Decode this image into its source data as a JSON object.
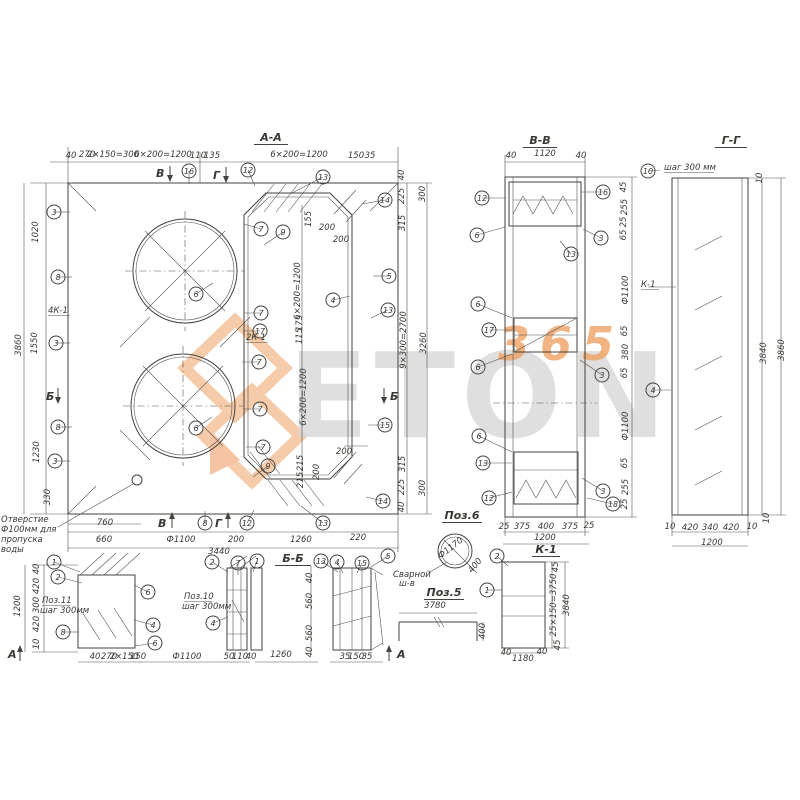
{
  "doc": {
    "type": "reinforcement-drawing",
    "note_lines": [
      "Отверстие",
      "Ф100мм для",
      "пропуска",
      "воды"
    ],
    "ink_color": "#44423e",
    "accent_color": "#ef9459"
  },
  "watermark": {
    "brand": "ETON",
    "digits": "365"
  },
  "titles": [
    {
      "t": "А-А",
      "x": 271,
      "y": 141,
      "w": 34
    },
    {
      "t": "В-В",
      "x": 540,
      "y": 144,
      "w": 34
    },
    {
      "t": "Г-Г",
      "x": 731,
      "y": 144,
      "w": 32
    },
    {
      "t": "Б-Б",
      "x": 293,
      "y": 562,
      "w": 36
    },
    {
      "t": "Поз.6",
      "x": 462,
      "y": 519,
      "w": 40
    },
    {
      "t": "Поз.5",
      "x": 444,
      "y": 596,
      "w": 40
    },
    {
      "t": "К-1",
      "x": 546,
      "y": 553,
      "w": 28
    }
  ],
  "labels": [
    {
      "t": "4К-1",
      "x": 48,
      "y": 313,
      "u": 22
    },
    {
      "t": "2К-1",
      "x": 246,
      "y": 340,
      "u": 22
    },
    {
      "t": "К-1",
      "x": 641,
      "y": 287,
      "u": 18
    },
    {
      "t": "шаг 300 мм",
      "x": 664,
      "y": 170,
      "u": 50
    },
    {
      "t": "Поз.11",
      "x": 42,
      "y": 603,
      "u": 28
    },
    {
      "t": "шаг 300мм",
      "x": 40,
      "y": 613
    },
    {
      "t": "Поз.10",
      "x": 184,
      "y": 599,
      "u": 28
    },
    {
      "t": "шаг 300мм",
      "x": 182,
      "y": 609
    },
    {
      "t": "Сварной",
      "x": 393,
      "y": 577
    },
    {
      "t": "ш-в",
      "x": 399,
      "y": 586
    },
    {
      "t": "Отверстие",
      "x": 1,
      "y": 522
    },
    {
      "t": "Ф100мм для",
      "x": 1,
      "y": 532
    },
    {
      "t": "пропуска",
      "x": 1,
      "y": 542
    },
    {
      "t": "воды",
      "x": 1,
      "y": 552
    }
  ],
  "dims": [
    {
      "t": "40",
      "x": 71,
      "y": 158,
      "fs": 7
    },
    {
      "t": "270",
      "x": 87,
      "y": 157
    },
    {
      "t": "2×150=300",
      "x": 113,
      "y": 157,
      "fs": 6.5
    },
    {
      "t": "6×200=1200",
      "x": 163,
      "y": 157
    },
    {
      "t": "110",
      "x": 198,
      "y": 158,
      "fs": 7
    },
    {
      "t": "135",
      "x": 212,
      "y": 158,
      "fs": 7
    },
    {
      "t": "6×200=1200",
      "x": 299,
      "y": 157
    },
    {
      "t": "150",
      "x": 356,
      "y": 158,
      "fs": 7
    },
    {
      "t": "35",
      "x": 370,
      "y": 158,
      "fs": 7
    },
    {
      "t": "1020",
      "x": 38,
      "y": 232,
      "r": -90
    },
    {
      "t": "1550",
      "x": 37,
      "y": 343,
      "r": -90
    },
    {
      "t": "1230",
      "x": 39,
      "y": 452,
      "r": -90
    },
    {
      "t": "330",
      "x": 50,
      "y": 497,
      "r": -90
    },
    {
      "t": "3860",
      "x": 21,
      "y": 345,
      "r": -90
    },
    {
      "t": "40",
      "x": 404,
      "y": 175,
      "r": -90,
      "fs": 7
    },
    {
      "t": "225",
      "x": 404,
      "y": 196,
      "r": -90
    },
    {
      "t": "315",
      "x": 405,
      "y": 223,
      "r": -90
    },
    {
      "t": "9×300=2700",
      "x": 406,
      "y": 340,
      "r": -90
    },
    {
      "t": "315",
      "x": 405,
      "y": 464,
      "r": -90
    },
    {
      "t": "225",
      "x": 404,
      "y": 487,
      "r": -90
    },
    {
      "t": "40",
      "x": 404,
      "y": 507,
      "r": -90,
      "fs": 7
    },
    {
      "t": "300",
      "x": 425,
      "y": 194,
      "r": -90
    },
    {
      "t": "3260",
      "x": 426,
      "y": 343,
      "r": -90
    },
    {
      "t": "300",
      "x": 425,
      "y": 488,
      "r": -90
    },
    {
      "t": "760",
      "x": 105,
      "y": 525
    },
    {
      "t": "660",
      "x": 104,
      "y": 542
    },
    {
      "t": "Ф1100",
      "x": 181,
      "y": 542
    },
    {
      "t": "200",
      "x": 236,
      "y": 542
    },
    {
      "t": "1260",
      "x": 301,
      "y": 542
    },
    {
      "t": "220",
      "x": 358,
      "y": 540
    },
    {
      "t": "3440",
      "x": 219,
      "y": 554
    },
    {
      "t": "155",
      "x": 311,
      "y": 219,
      "r": -90,
      "fs": 7
    },
    {
      "t": "200",
      "x": 327,
      "y": 230,
      "fs": 7
    },
    {
      "t": "200",
      "x": 341,
      "y": 242,
      "fs": 7
    },
    {
      "t": "6×200=1200",
      "x": 300,
      "y": 291,
      "r": -90
    },
    {
      "t": "175",
      "x": 302,
      "y": 323,
      "r": -90,
      "fs": 7
    },
    {
      "t": "115",
      "x": 302,
      "y": 336,
      "r": -90,
      "fs": 7
    },
    {
      "t": "6×200=1200",
      "x": 306,
      "y": 397,
      "r": -90
    },
    {
      "t": "215",
      "x": 303,
      "y": 463,
      "r": -90,
      "fs": 7
    },
    {
      "t": "215",
      "x": 303,
      "y": 480,
      "r": -90,
      "fs": 7
    },
    {
      "t": "200",
      "x": 344,
      "y": 454,
      "fs": 7
    },
    {
      "t": "200",
      "x": 319,
      "y": 472,
      "r": -90,
      "fs": 7
    },
    {
      "t": "40",
      "x": 511,
      "y": 158,
      "fs": 7
    },
    {
      "t": "1120",
      "x": 545,
      "y": 156
    },
    {
      "t": "40",
      "x": 581,
      "y": 158,
      "fs": 7
    },
    {
      "t": "45",
      "x": 626,
      "y": 187,
      "r": -90,
      "fs": 7
    },
    {
      "t": "255",
      "x": 627,
      "y": 207,
      "r": -90
    },
    {
      "t": "25",
      "x": 626,
      "y": 222,
      "r": -90,
      "fs": 7
    },
    {
      "t": "65",
      "x": 626,
      "y": 235,
      "r": -90,
      "fs": 7
    },
    {
      "t": "Ф1100",
      "x": 628,
      "y": 290,
      "r": -90
    },
    {
      "t": "65",
      "x": 627,
      "y": 331,
      "r": -90,
      "fs": 7
    },
    {
      "t": "380",
      "x": 628,
      "y": 352,
      "r": -90
    },
    {
      "t": "65",
      "x": 627,
      "y": 373,
      "r": -90,
      "fs": 7
    },
    {
      "t": "Ф1100",
      "x": 628,
      "y": 426,
      "r": -90
    },
    {
      "t": "65",
      "x": 627,
      "y": 463,
      "r": -90,
      "fs": 7
    },
    {
      "t": "255",
      "x": 628,
      "y": 487,
      "r": -90
    },
    {
      "t": "25",
      "x": 627,
      "y": 504,
      "r": -90,
      "fs": 7
    },
    {
      "t": "25",
      "x": 504,
      "y": 529,
      "fs": 7
    },
    {
      "t": "375",
      "x": 522,
      "y": 529
    },
    {
      "t": "400",
      "x": 546,
      "y": 529
    },
    {
      "t": "375",
      "x": 570,
      "y": 529
    },
    {
      "t": "25",
      "x": 589,
      "y": 528,
      "fs": 7
    },
    {
      "t": "1200",
      "x": 545,
      "y": 540
    },
    {
      "t": "10",
      "x": 762,
      "y": 178,
      "r": -90,
      "fs": 7
    },
    {
      "t": "3840",
      "x": 766,
      "y": 353,
      "r": -90
    },
    {
      "t": "3860",
      "x": 784,
      "y": 350,
      "r": -90
    },
    {
      "t": "10",
      "x": 769,
      "y": 518,
      "r": -90,
      "fs": 7
    },
    {
      "t": "10",
      "x": 670,
      "y": 529,
      "fs": 7
    },
    {
      "t": "420",
      "x": 690,
      "y": 530
    },
    {
      "t": "340",
      "x": 710,
      "y": 530
    },
    {
      "t": "420",
      "x": 731,
      "y": 530
    },
    {
      "t": "10",
      "x": 752,
      "y": 529,
      "fs": 7
    },
    {
      "t": "1200",
      "x": 712,
      "y": 545
    },
    {
      "t": "40",
      "x": 39,
      "y": 569,
      "r": -90,
      "fs": 7
    },
    {
      "t": "420",
      "x": 39,
      "y": 586,
      "r": -90
    },
    {
      "t": "300",
      "x": 39,
      "y": 605,
      "r": -90
    },
    {
      "t": "420",
      "x": 39,
      "y": 624,
      "r": -90
    },
    {
      "t": "10",
      "x": 39,
      "y": 644,
      "r": -90,
      "fs": 7
    },
    {
      "t": "1200",
      "x": 20,
      "y": 606,
      "r": -90
    },
    {
      "t": "40",
      "x": 312,
      "y": 578,
      "r": -90,
      "fs": 7
    },
    {
      "t": "560",
      "x": 312,
      "y": 601,
      "r": -90
    },
    {
      "t": "560",
      "x": 312,
      "y": 633,
      "r": -90
    },
    {
      "t": "40",
      "x": 312,
      "y": 652,
      "r": -90,
      "fs": 7
    },
    {
      "t": "40",
      "x": 95,
      "y": 659,
      "fs": 6.5
    },
    {
      "t": "270",
      "x": 109,
      "y": 659,
      "fs": 6.5
    },
    {
      "t": "2×150",
      "x": 124,
      "y": 659,
      "fs": 6.5
    },
    {
      "t": "150",
      "x": 138,
      "y": 659,
      "fs": 6.5
    },
    {
      "t": "Ф1100",
      "x": 187,
      "y": 659
    },
    {
      "t": "50",
      "x": 229,
      "y": 659,
      "fs": 6.5
    },
    {
      "t": "110",
      "x": 240,
      "y": 659,
      "fs": 6.5
    },
    {
      "t": "40",
      "x": 251,
      "y": 659,
      "fs": 6.5
    },
    {
      "t": "1260",
      "x": 281,
      "y": 657
    },
    {
      "t": "35",
      "x": 345,
      "y": 659,
      "fs": 6.5
    },
    {
      "t": "150",
      "x": 356,
      "y": 659,
      "fs": 6.5
    },
    {
      "t": "35",
      "x": 367,
      "y": 659,
      "fs": 6.5
    },
    {
      "t": "3780",
      "x": 435,
      "y": 608
    },
    {
      "t": "400",
      "x": 485,
      "y": 631,
      "r": -90
    },
    {
      "t": "Ф1170",
      "x": 452,
      "y": 550,
      "r": -38
    },
    {
      "t": "400",
      "x": 477,
      "y": 567,
      "r": -50,
      "fs": 7
    },
    {
      "t": "45",
      "x": 558,
      "y": 567,
      "r": -90,
      "fs": 7
    },
    {
      "t": "25×150=3750",
      "x": 556,
      "y": 605,
      "r": -90,
      "fs": 6.5
    },
    {
      "t": "3840",
      "x": 569,
      "y": 605,
      "r": -90
    },
    {
      "t": "45",
      "x": 560,
      "y": 645,
      "r": -90,
      "fs": 7
    },
    {
      "t": "40",
      "x": 506,
      "y": 655,
      "fs": 6.5
    },
    {
      "t": "1180",
      "x": 523,
      "y": 661
    },
    {
      "t": "40",
      "x": 542,
      "y": 654,
      "fs": 6.5
    }
  ],
  "bubbles": [
    {
      "n": "16",
      "x": 189,
      "y": 171,
      "lx": 189,
      "ly": 184
    },
    {
      "n": "12",
      "x": 248,
      "y": 170,
      "lx": 255,
      "ly": 186
    },
    {
      "n": "13",
      "x": 323,
      "y": 177,
      "lx": 292,
      "ly": 193
    },
    {
      "n": "14",
      "x": 385,
      "y": 200,
      "lx": 362,
      "ly": 204
    },
    {
      "n": "3",
      "x": 54,
      "y": 212,
      "lx": 70,
      "ly": 212
    },
    {
      "n": "8",
      "x": 58,
      "y": 277,
      "lx": 72,
      "ly": 277
    },
    {
      "n": "3",
      "x": 56,
      "y": 343,
      "lx": 70,
      "ly": 343
    },
    {
      "n": "8",
      "x": 58,
      "y": 427,
      "lx": 72,
      "ly": 427
    },
    {
      "n": "3",
      "x": 55,
      "y": 461,
      "lx": 70,
      "ly": 461
    },
    {
      "n": "7",
      "x": 261,
      "y": 229,
      "lx": 244,
      "ly": 224
    },
    {
      "n": "9",
      "x": 283,
      "y": 232,
      "lx": 264,
      "ly": 245
    },
    {
      "n": "6",
      "x": 196,
      "y": 294,
      "lx": 213,
      "ly": 283
    },
    {
      "n": "7",
      "x": 261,
      "y": 313,
      "lx": 244,
      "ly": 313
    },
    {
      "n": "17",
      "x": 260,
      "y": 331,
      "lx": 243,
      "ly": 331
    },
    {
      "n": "5",
      "x": 389,
      "y": 276,
      "lx": 373,
      "ly": 276
    },
    {
      "n": "4",
      "x": 333,
      "y": 300,
      "lx": 350,
      "ly": 296
    },
    {
      "n": "13",
      "x": 388,
      "y": 310,
      "lx": 371,
      "ly": 318
    },
    {
      "n": "7",
      "x": 259,
      "y": 362,
      "lx": 242,
      "ly": 362
    },
    {
      "n": "7",
      "x": 260,
      "y": 409,
      "lx": 243,
      "ly": 409
    },
    {
      "n": "6",
      "x": 196,
      "y": 428,
      "lx": 212,
      "ly": 417
    },
    {
      "n": "7",
      "x": 263,
      "y": 447,
      "lx": 246,
      "ly": 447
    },
    {
      "n": "9",
      "x": 268,
      "y": 466,
      "lx": 253,
      "ly": 477
    },
    {
      "n": "15",
      "x": 385,
      "y": 425,
      "lx": 368,
      "ly": 425
    },
    {
      "n": "14",
      "x": 383,
      "y": 501,
      "lx": 366,
      "ly": 497
    },
    {
      "n": "8",
      "x": 205,
      "y": 523,
      "lx": 205,
      "ly": 511
    },
    {
      "n": "12",
      "x": 247,
      "y": 523,
      "lx": 254,
      "ly": 510
    },
    {
      "n": "13",
      "x": 323,
      "y": 523,
      "lx": 301,
      "ly": 506
    },
    {
      "n": "12",
      "x": 482,
      "y": 198,
      "lx": 506,
      "ly": 198
    },
    {
      "n": "16",
      "x": 603,
      "y": 192,
      "lx": 581,
      "ly": 192
    },
    {
      "n": "6",
      "x": 477,
      "y": 235,
      "lx": 505,
      "ly": 227
    },
    {
      "n": "3",
      "x": 601,
      "y": 238,
      "lx": 583,
      "ly": 229
    },
    {
      "n": "13",
      "x": 571,
      "y": 254,
      "lx": 560,
      "ly": 241
    },
    {
      "n": "6",
      "x": 478,
      "y": 304,
      "lx": 512,
      "ly": 318
    },
    {
      "n": "17",
      "x": 489,
      "y": 330,
      "lx": 512,
      "ly": 330
    },
    {
      "n": "6",
      "x": 478,
      "y": 367,
      "lx": 512,
      "ly": 354
    },
    {
      "n": "3",
      "x": 602,
      "y": 375,
      "lx": 580,
      "ly": 360
    },
    {
      "n": "6",
      "x": 479,
      "y": 436,
      "lx": 512,
      "ly": 452
    },
    {
      "n": "13",
      "x": 483,
      "y": 463,
      "lx": 512,
      "ly": 463
    },
    {
      "n": "12",
      "x": 489,
      "y": 498,
      "lx": 512,
      "ly": 492
    },
    {
      "n": "3",
      "x": 603,
      "y": 491,
      "lx": 582,
      "ly": 478
    },
    {
      "n": "18",
      "x": 613,
      "y": 504,
      "lx": 587,
      "ly": 498
    },
    {
      "n": "10",
      "x": 648,
      "y": 171,
      "lx": 660,
      "ly": 170
    },
    {
      "n": "4",
      "x": 653,
      "y": 390,
      "lx": 671,
      "ly": 390
    },
    {
      "n": "1",
      "x": 54,
      "y": 562,
      "lx": 80,
      "ly": 572
    },
    {
      "n": "2",
      "x": 58,
      "y": 577,
      "lx": 82,
      "ly": 583
    },
    {
      "n": "6",
      "x": 148,
      "y": 592,
      "lx": 134,
      "ly": 585
    },
    {
      "n": "4",
      "x": 153,
      "y": 625,
      "lx": 134,
      "ly": 620
    },
    {
      "n": "8",
      "x": 63,
      "y": 632,
      "lx": 79,
      "ly": 632
    },
    {
      "n": "6",
      "x": 155,
      "y": 643,
      "lx": 135,
      "ly": 646
    },
    {
      "n": "2",
      "x": 212,
      "y": 562,
      "lx": 228,
      "ly": 572
    },
    {
      "n": "7",
      "x": 238,
      "y": 563,
      "lx": 238,
      "ly": 575
    },
    {
      "n": "1",
      "x": 257,
      "y": 561,
      "lx": 253,
      "ly": 572
    },
    {
      "n": "4",
      "x": 213,
      "y": 623,
      "lx": 228,
      "ly": 617
    },
    {
      "n": "13",
      "x": 321,
      "y": 561,
      "lx": 338,
      "ly": 572
    },
    {
      "n": "4",
      "x": 337,
      "y": 562,
      "lx": 343,
      "ly": 573
    },
    {
      "n": "15",
      "x": 362,
      "y": 563,
      "lx": 357,
      "ly": 573
    },
    {
      "n": "5",
      "x": 388,
      "y": 556,
      "lx": 371,
      "ly": 567
    },
    {
      "n": "2",
      "x": 497,
      "y": 556,
      "lx": 508,
      "ly": 566
    },
    {
      "n": "1",
      "x": 487,
      "y": 590,
      "lx": 502,
      "ly": 590
    }
  ],
  "markers": [
    {
      "t": "В",
      "x": 156,
      "y": 177,
      "x1": 170,
      "y1": 166,
      "x2": 170,
      "y2": 181
    },
    {
      "t": "Г",
      "x": 213,
      "y": 179,
      "x1": 226,
      "y1": 167,
      "x2": 226,
      "y2": 182
    },
    {
      "t": "Б",
      "x": 46,
      "y": 400,
      "x1": 58,
      "y1": 388,
      "x2": 58,
      "y2": 403
    },
    {
      "t": "Б",
      "x": 390,
      "y": 400,
      "x1": 384,
      "y1": 388,
      "x2": 384,
      "y2": 403
    },
    {
      "t": "В",
      "x": 158,
      "y": 527,
      "x1": 172,
      "y1": 528,
      "x2": 172,
      "y2": 513
    },
    {
      "t": "Г",
      "x": 215,
      "y": 527,
      "x1": 228,
      "y1": 528,
      "x2": 228,
      "y2": 513
    },
    {
      "t": "А",
      "x": 397,
      "y": 658,
      "x1": 389,
      "y1": 661,
      "x2": 389,
      "y2": 646
    },
    {
      "t": "А",
      "x": 8,
      "y": 658,
      "x1": 20,
      "y1": 661,
      "x2": 20,
      "y2": 646
    }
  ]
}
